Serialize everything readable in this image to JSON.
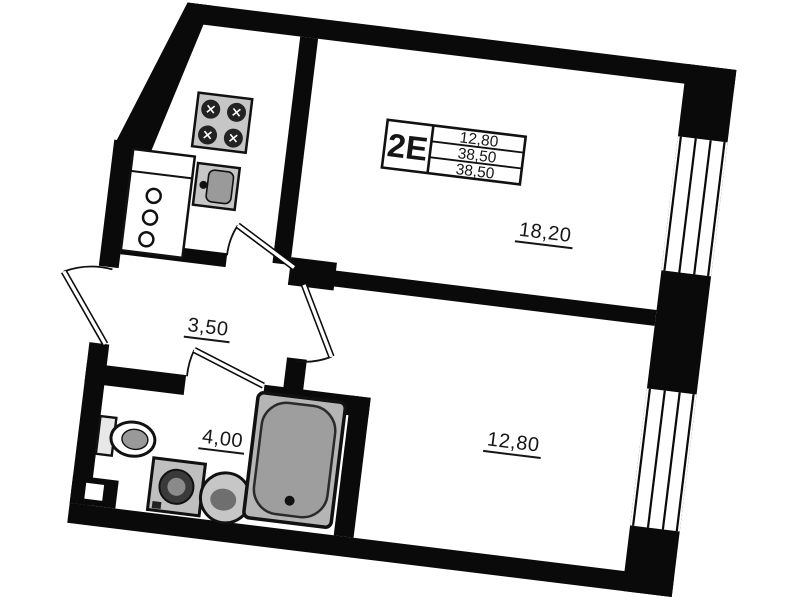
{
  "plan": {
    "unit_type": "2E",
    "title_block": {
      "values": [
        "12,80",
        "38,50",
        "38,50"
      ]
    },
    "rooms": {
      "living_room_area": "18,20",
      "hall_area": "3,50",
      "bathroom_area": "4,00",
      "bedroom_area": "12,80"
    }
  },
  "colors": {
    "wall_color": "#0a0a0a",
    "paper_color": "#ffffff",
    "line_color": "#111111",
    "label_color": "#161616",
    "fixture_fill": "#c6c6c6",
    "tub_rim_fill": "#b5b5b5",
    "tub_fill": "#9e9e9e",
    "drum_fill": "#3a3a3a"
  }
}
